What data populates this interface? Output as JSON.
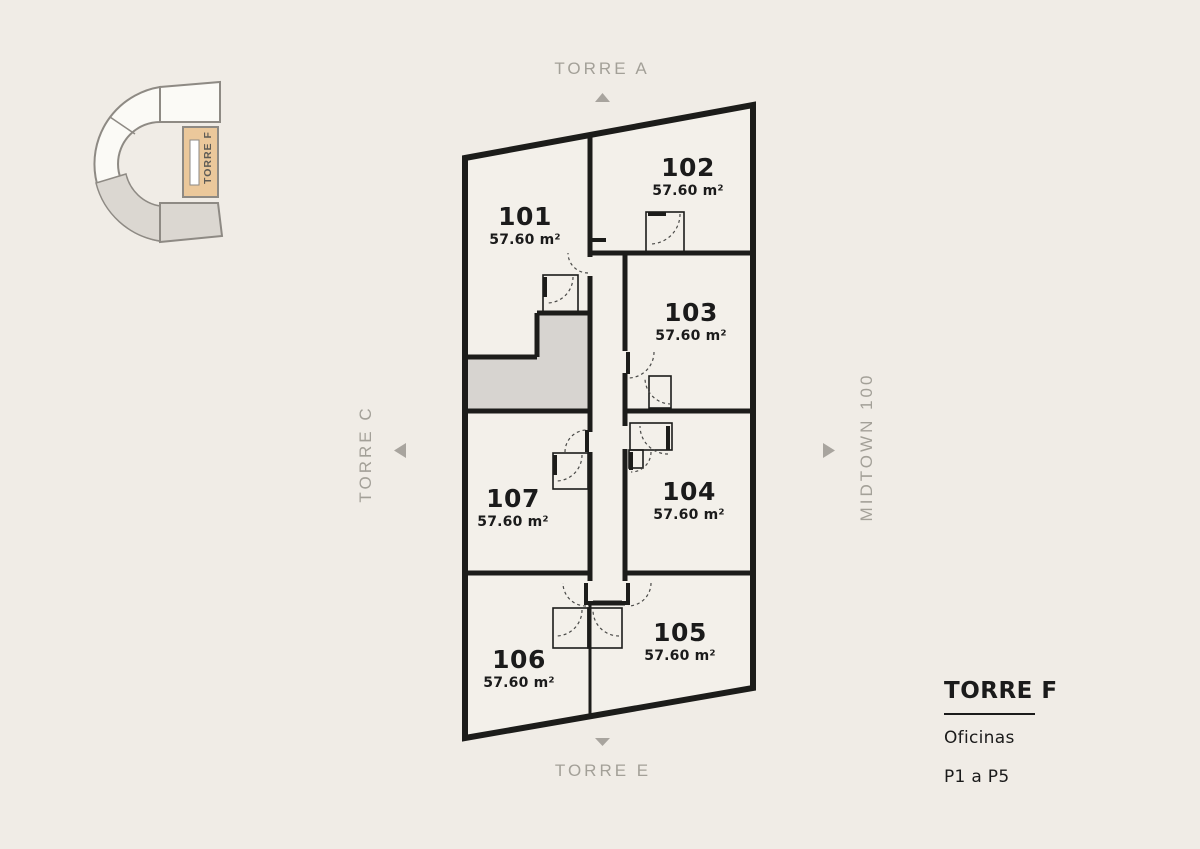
{
  "locator": {
    "label": "TORRE F"
  },
  "directions": {
    "top": "TORRE A",
    "left": "TORRE C",
    "right": "MIDTOWN 100",
    "bottom": "TORRE E"
  },
  "plan": {
    "units": [
      {
        "number": "101",
        "area": "57.60 m²"
      },
      {
        "number": "102",
        "area": "57.60 m²"
      },
      {
        "number": "103",
        "area": "57.60 m²"
      },
      {
        "number": "104",
        "area": "57.60 m²"
      },
      {
        "number": "105",
        "area": "57.60 m²"
      },
      {
        "number": "106",
        "area": "57.60 m²"
      },
      {
        "number": "107",
        "area": "57.60 m²"
      }
    ]
  },
  "legend": {
    "title": "TORRE F",
    "subtitle": "Oficinas",
    "floors": "P1 a P5"
  },
  "colors": {
    "background": "#f0ece6",
    "walls": "#1c1c1a",
    "room_fill": "#f3f0ea",
    "core_fill": "#d7d4d0",
    "accent_tan": "#ebc89b",
    "muted_text": "#a3a098",
    "dark_text": "#1b1b1b"
  }
}
